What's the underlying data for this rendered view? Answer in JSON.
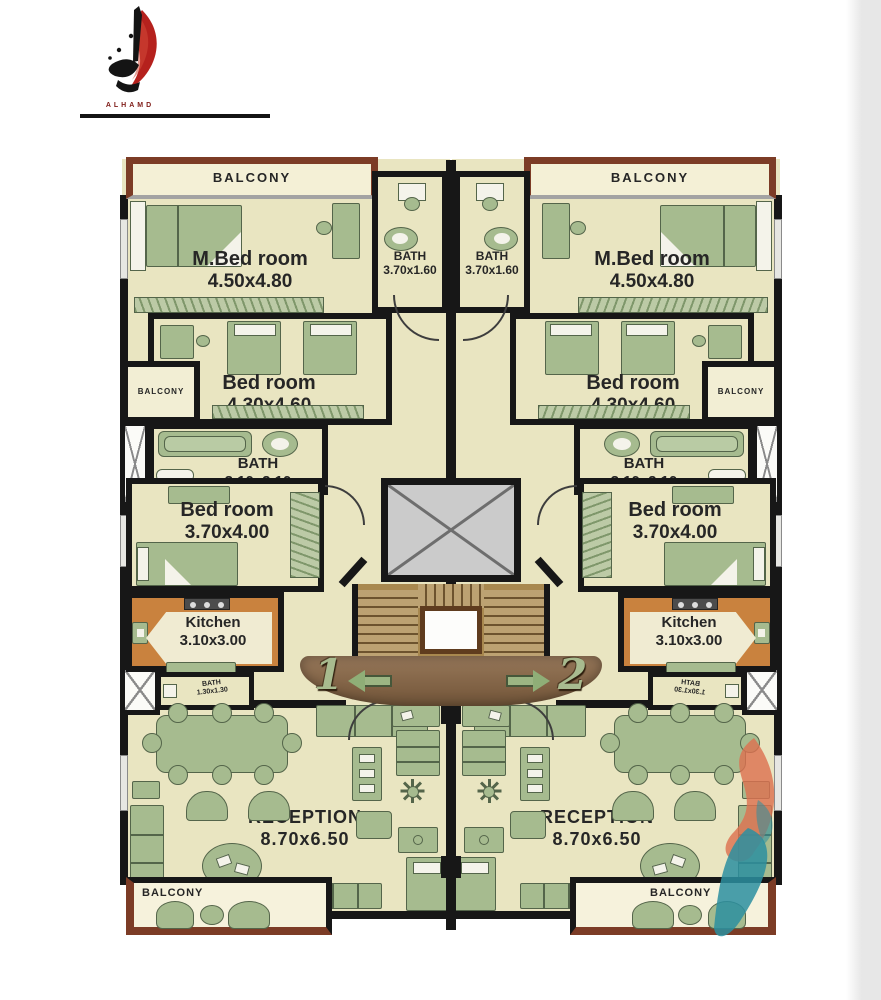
{
  "logo": {
    "brand": "ALHAMD"
  },
  "rooms": {
    "balcony": "BALCONY",
    "master_bedroom": {
      "name": "M.Bed room",
      "dim": "4.50x4.80"
    },
    "bath_master": {
      "name": "BATH",
      "dim": "3.70x1.60"
    },
    "bedroom_2": {
      "name": "Bed room",
      "dim": "4.30x4.60"
    },
    "bath_2": {
      "name": "BATH",
      "dim": "3.10x2.10"
    },
    "bedroom_3": {
      "name": "Bed room",
      "dim": "3.70x4.00"
    },
    "kitchen": {
      "name": "Kitchen",
      "dim": "3.10x3.00"
    },
    "bath_small": {
      "name": "BATH",
      "dim": "1.30x1.30"
    },
    "reception": {
      "name": "RECEPTION",
      "dim": "8.70x6.50"
    }
  },
  "units": {
    "left_number": "1",
    "right_number": "2"
  },
  "colors": {
    "wall": "#171717",
    "room_fill": "#e9e5c1",
    "balcony_fill": "#f4f0d6",
    "kitchen_fill": "#c9823e",
    "furniture": "#a6bb8f",
    "furniture_line": "#54654a",
    "balcony_wall_brown": "#7c3c26",
    "elevator_fill": "#cbcbcb",
    "stair_fill": "#a8884f",
    "landing_brown": "#8a6b4a",
    "arrow_green": "#9cb583",
    "logo_red": "#b5211d",
    "watermark_orange": "#dd7150",
    "watermark_teal": "#2b8fa0"
  }
}
